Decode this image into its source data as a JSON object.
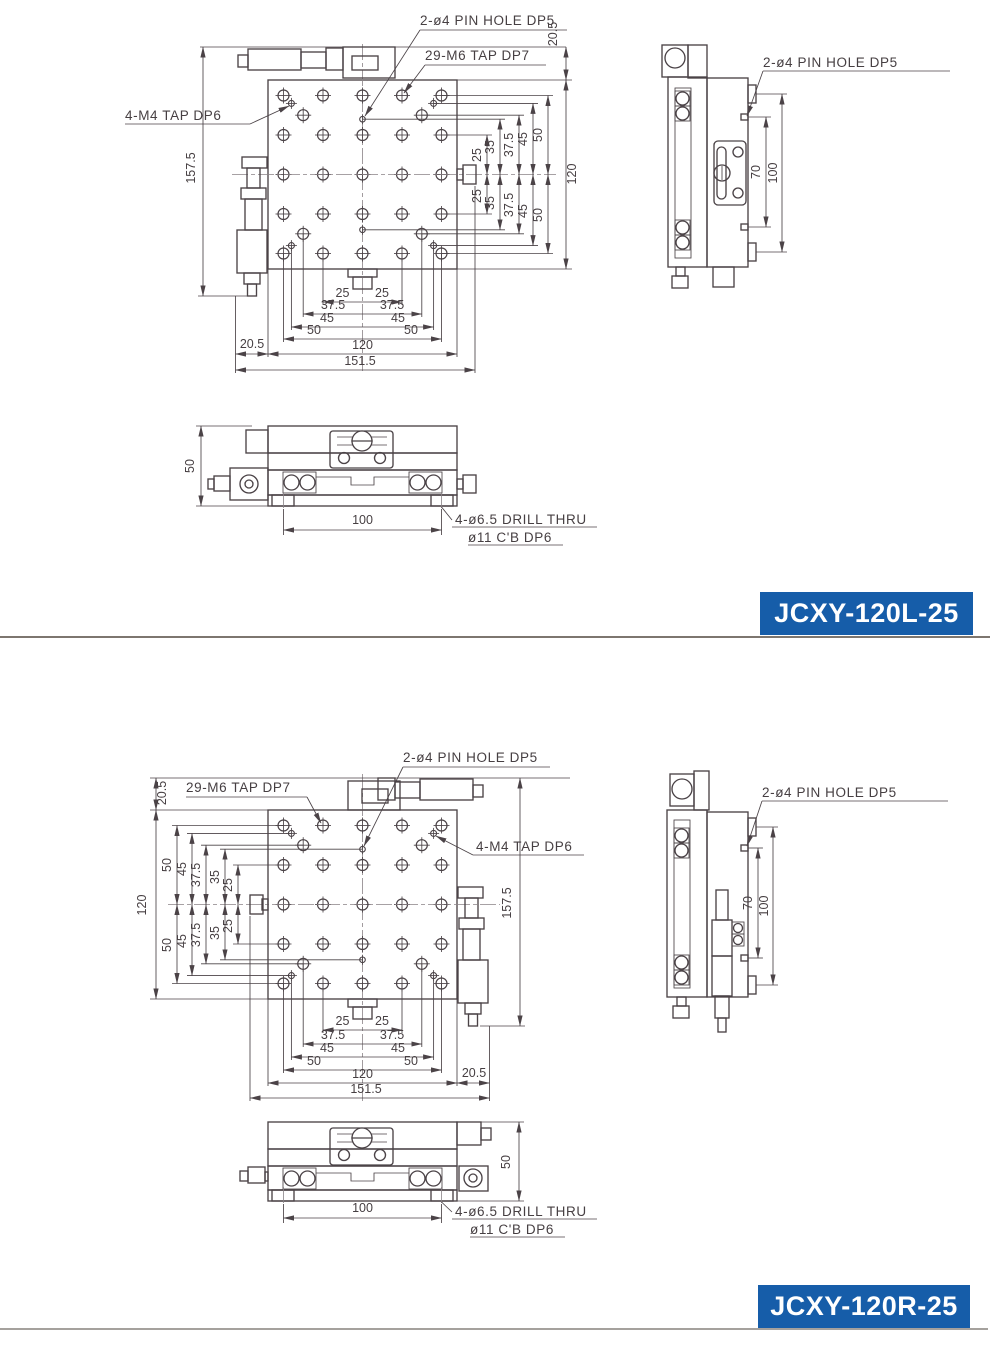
{
  "drawing": {
    "sheet_bg": "#ffffff",
    "line_color": "#4b4347",
    "accent_blue": "#165da9",
    "divider_color": "#7d766f",
    "models": {
      "left": {
        "name": "JCXY-120L-25"
      },
      "right": {
        "name": "JCXY-120R-25"
      }
    },
    "callouts": {
      "pin_hole": "2-ø4 PIN HOLE DP5",
      "m6_tap": "29-M6 TAP DP7",
      "m4_tap": "4-M4 TAP DP6",
      "drill_thru": "4-ø6.5 DRILL THRU",
      "counterbore": "ø11 C'B DP6"
    },
    "dims": {
      "d20_5": "20.5",
      "d25": "25",
      "d35": "35",
      "d37_5": "37.5",
      "d45": "45",
      "d50": "50",
      "d70": "70",
      "d100": "100",
      "d120": "120",
      "d151_5": "151.5",
      "d157_5": "157.5"
    }
  }
}
